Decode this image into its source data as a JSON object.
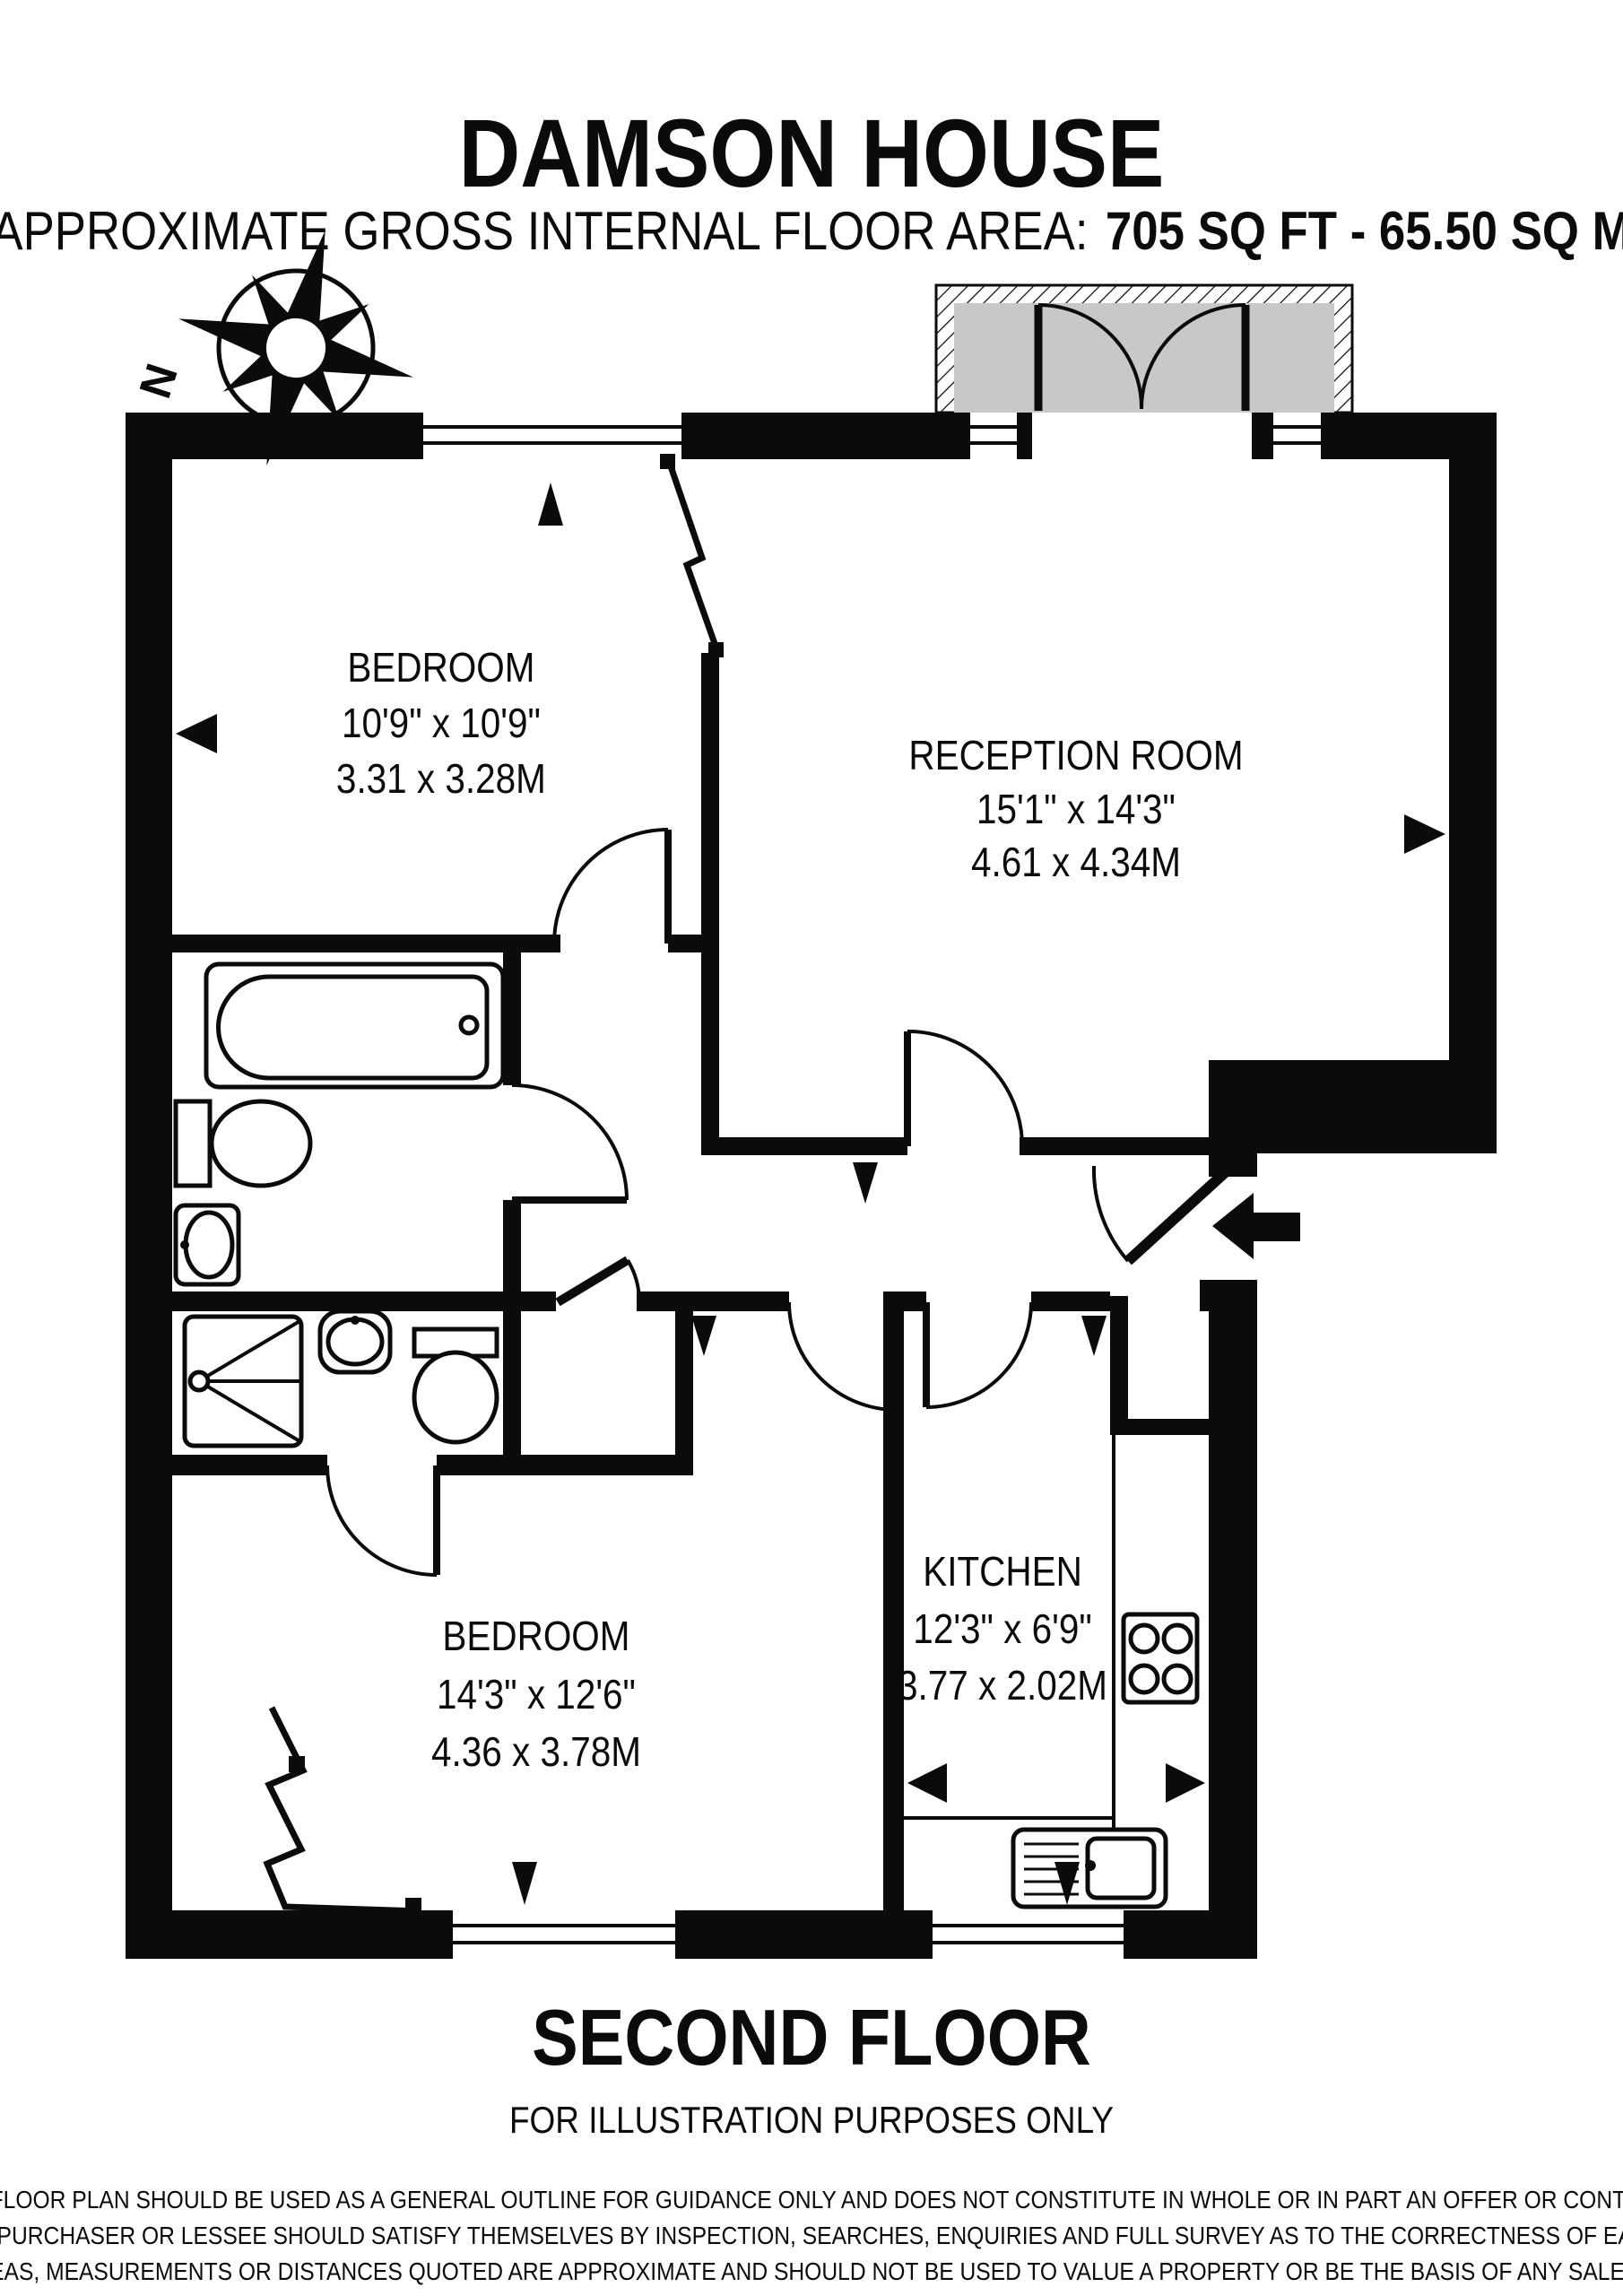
{
  "header": {
    "title": "DAMSON HOUSE",
    "area_label": "APPROXIMATE GROSS INTERNAL FLOOR AREA:",
    "area_value": "705 SQ FT  -  65.50 SQ M"
  },
  "compass": {
    "north_label": "N"
  },
  "rooms": {
    "bedroom1": {
      "name": "BEDROOM",
      "imperial": "10'9\" x 10'9\"",
      "metric": "3.31 x 3.28M"
    },
    "reception": {
      "name": "RECEPTION ROOM",
      "imperial": "15'1\" x 14'3\"",
      "metric": "4.61 x 4.34M"
    },
    "kitchen": {
      "name": "KITCHEN",
      "imperial": "12'3\" x 6'9\"",
      "metric": "3.77 x 2.02M"
    },
    "bedroom2": {
      "name": "BEDROOM",
      "imperial": "14'3\" x 12'6\"",
      "metric": "4.36 x 3.78M"
    }
  },
  "footer": {
    "floor_label": "SECOND FLOOR",
    "note": "FOR ILLUSTRATION PURPOSES ONLY",
    "disclaimer": [
      "THIS FLOOR PLAN SHOULD BE USED AS A GENERAL OUTLINE FOR GUIDANCE ONLY AND DOES NOT CONSTITUTE IN WHOLE OR IN PART AN OFFER OR CONTRACT.",
      "ANY INTENDING PURCHASER OR LESSEE SHOULD SATISFY THEMSELVES BY INSPECTION, SEARCHES, ENQUIRIES AND FULL SURVEY AS TO THE CORRECTNESS OF EACH STATEMENT.",
      "ANY AREAS, MEASUREMENTS OR DISTANCES QUOTED ARE APPROXIMATE AND SHOULD NOT BE USED TO VALUE A PROPERTY OR BE THE BASIS OF ANY SALE OR LET."
    ]
  },
  "colors": {
    "ink": "#0b0b0b",
    "balcony_fill": "#c8c8c8"
  }
}
